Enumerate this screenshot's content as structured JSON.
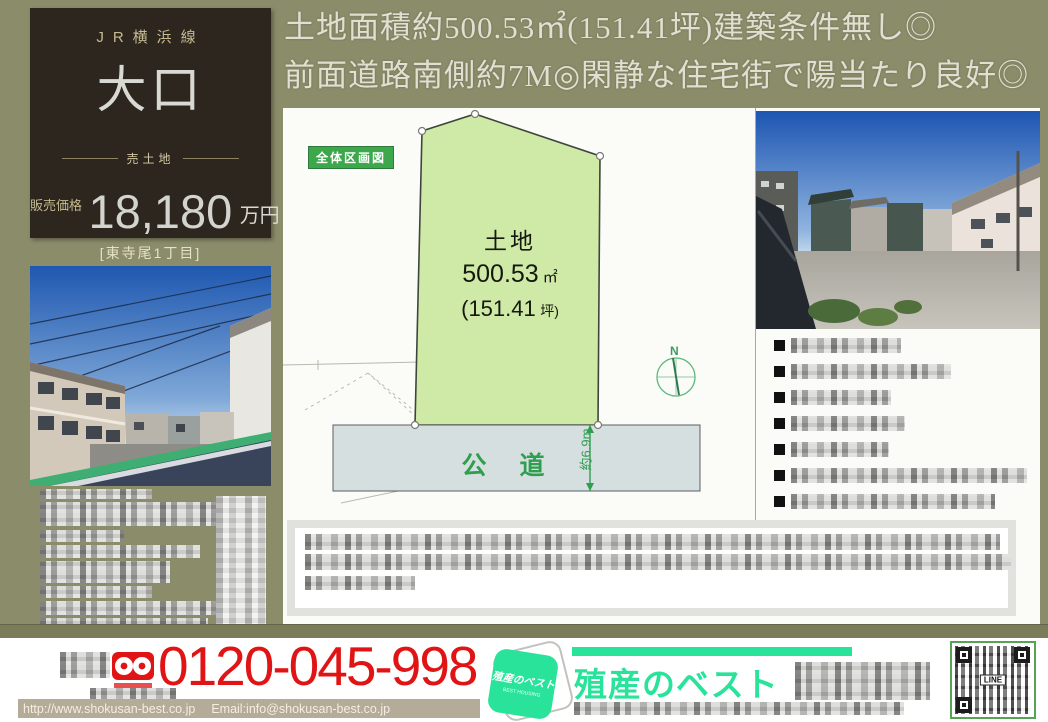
{
  "colors": {
    "bg_olive": "#8b8c6a",
    "dark_box": "#2c261e",
    "accent_red": "#e01414",
    "brand_green": "#2ae39b",
    "badge_green": "#3da84b",
    "road_green": "#2f9e4f",
    "land_green": "#cfe9a6"
  },
  "header": {
    "line1": "土地面積約500.53㎡(151.41坪)建築条件無し◎",
    "line2": "前面道路南側約7M◎閑静な住宅街で陽当たり良好◎"
  },
  "price_box": {
    "rail_line": "JR横浜線",
    "station": "大口",
    "sale_type": "売土地",
    "price_label": "販売価格",
    "price_value": "18,180",
    "price_unit": "万円",
    "location": "[東寺尾1丁目]"
  },
  "diagram": {
    "badge": "全体区画図",
    "land_label": "土地",
    "area_sqm_value": "500.53",
    "area_sqm_unit": "㎡",
    "area_tsubo_value": "(151.41",
    "area_tsubo_unit": "坪)",
    "road_label": "公　道",
    "road_width_label": "約6.9m",
    "compass_label": "N"
  },
  "footer": {
    "phone_number": "0120-045-998",
    "website_url": "http://www.shokusan-best.co.jp",
    "email": "Email:info@shokusan-best.co.jp",
    "brand_name": "殖産のベスト",
    "logo_text": "殖産のベスト",
    "qr_label": "LINE"
  }
}
